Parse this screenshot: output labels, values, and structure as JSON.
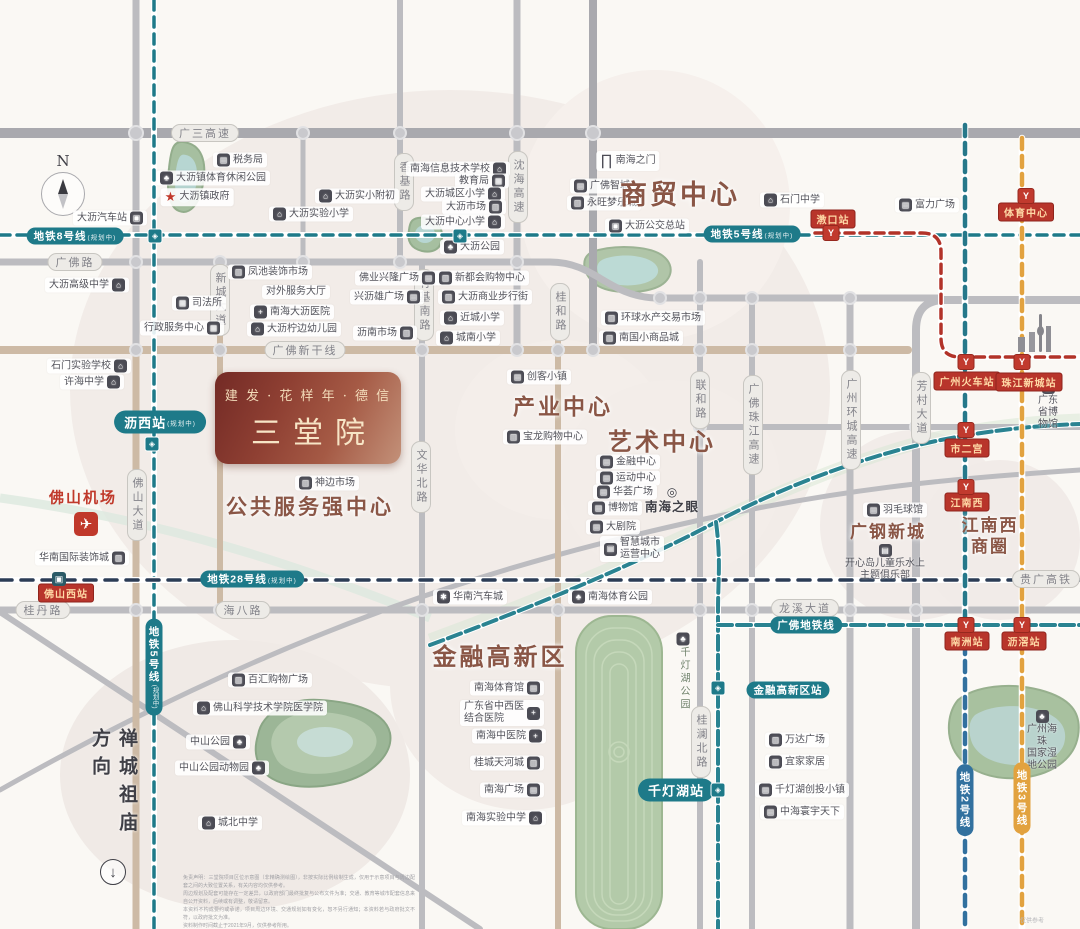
{
  "colors": {
    "metro_teal": "#1e7a89",
    "rail_navy": "#2b3c55",
    "metro_red": "#b23329",
    "metro_orange": "#e2a23f",
    "metro_blue": "#32719f",
    "brand_dark_red": "#732a25",
    "brand_bronze": "#c39179",
    "district_brown": "#8a5646",
    "road_grey": "#bcbcc0",
    "road_tan": "#cdbaa5",
    "park_green": "#a6bfa0",
    "station_badge_red": "#b8352b"
  },
  "logo": {
    "line1": "建 发 · 花 样 年 · 德 信",
    "line2": "三堂院"
  },
  "compass": {
    "n": "N"
  },
  "airport": {
    "label": "佛山机场",
    "x": 83,
    "y": 497,
    "icon": "plane-icon",
    "icon_x": 86,
    "icon_y": 524,
    "icon_glyph": "✈"
  },
  "direction_note": {
    "text": "禅城祖庙方向",
    "x": 113,
    "y": 795,
    "arrow": "↓",
    "arrow_x": 113,
    "arrow_y": 872
  },
  "watermark": {
    "text": "仅供参考",
    "x": 1032,
    "y": 920
  },
  "districts": [
    [
      "商贸中心",
      680,
      196,
      27
    ],
    [
      "产业中心",
      563,
      407,
      22
    ],
    [
      "艺术中心",
      662,
      443,
      24
    ],
    [
      "公共服务强中心",
      310,
      508,
      21
    ],
    [
      "金融高新区",
      500,
      658,
      24
    ],
    [
      "广钢新城",
      888,
      532,
      17
    ],
    [
      "江南西\n商圈",
      990,
      536,
      17
    ]
  ],
  "road_labels": [
    [
      "广三高速",
      205,
      133,
      "h"
    ],
    [
      "广佛路",
      75,
      262,
      "h"
    ],
    [
      "广佛新干线",
      305,
      350,
      "h"
    ],
    [
      "桂丹路",
      43,
      610,
      "h"
    ],
    [
      "海八路",
      243,
      610,
      "h"
    ],
    [
      "龙溪大道",
      805,
      608,
      "h"
    ],
    [
      "贵广高铁",
      1046,
      579,
      "h"
    ],
    [
      "香基路",
      404,
      182,
      "v"
    ],
    [
      "沈海高速",
      518,
      187,
      "v"
    ],
    [
      "新城大道",
      220,
      300,
      "v"
    ],
    [
      "竹基南路",
      424,
      305,
      "v"
    ],
    [
      "桂和路",
      560,
      312,
      "v"
    ],
    [
      "文华北路",
      421,
      477,
      "v"
    ],
    [
      "联和路",
      700,
      400,
      "v"
    ],
    [
      "广佛珠江高速",
      753,
      425,
      "v"
    ],
    [
      "广州环城高速",
      851,
      420,
      "v"
    ],
    [
      "芳村大道",
      921,
      408,
      "v"
    ],
    [
      "桂澜北路",
      701,
      742,
      "v"
    ],
    [
      "佛山大道",
      137,
      505,
      "v"
    ]
  ],
  "metro_pills": [
    [
      "地铁8号线",
      "(规划中)",
      75,
      236,
      "h",
      "teal",
      "s"
    ],
    [
      "地铁5号线",
      "(规划中)",
      752,
      234,
      "h",
      "teal",
      "s"
    ],
    [
      "沥西站",
      "(规划中)",
      160,
      422,
      "h",
      "teal",
      "b"
    ],
    [
      "地铁28号线",
      "(规划中)",
      252,
      579,
      "h",
      "teal",
      "s"
    ],
    [
      "地铁5号线",
      "(规划中)",
      154,
      667,
      "v",
      "teal",
      "s"
    ],
    [
      "广佛地铁线",
      "",
      806,
      625,
      "h",
      "teal",
      "s"
    ],
    [
      "金融高新区站",
      "",
      788,
      690,
      "h",
      "teal",
      "s"
    ],
    [
      "千灯湖站",
      "",
      676,
      790,
      "h",
      "teal",
      "b"
    ],
    [
      "地铁2号线",
      "",
      965,
      800,
      "v",
      "blue",
      "s"
    ],
    [
      "地铁3号线",
      "",
      1022,
      798,
      "v",
      "orange",
      "s"
    ]
  ],
  "stations": [
    [
      "漖口站",
      833,
      219,
      "y",
      831,
      233
    ],
    [
      "体育中心",
      1026,
      212,
      "y",
      1026,
      196
    ],
    [
      "广州火车站",
      967,
      381,
      "y",
      966,
      362
    ],
    [
      "珠江新城站",
      1029,
      382,
      "y",
      1022,
      362
    ],
    [
      "市二宫",
      967,
      448,
      "y",
      966,
      430
    ],
    [
      "江南西",
      967,
      502,
      "y",
      966,
      487
    ],
    [
      "南洲站",
      967,
      641,
      "y",
      966,
      625
    ],
    [
      "沥滘站",
      1024,
      641,
      "y",
      1022,
      625
    ],
    [
      "佛山西站",
      66,
      593,
      "train",
      59,
      579
    ]
  ],
  "metro_glyphs": [
    [
      155,
      236
    ],
    [
      460,
      236
    ],
    [
      152,
      444
    ],
    [
      718,
      688
    ],
    [
      718,
      790
    ]
  ],
  "pois": [
    [
      "税务局",
      240,
      160,
      "l",
      "building"
    ],
    [
      "大沥镇体育休闲公园",
      213,
      178,
      "l",
      "park"
    ],
    [
      "大沥镇政府",
      197,
      197,
      "l",
      "star"
    ],
    [
      "大沥实验小学",
      311,
      214,
      "l",
      "school"
    ],
    [
      "大沥实小附初",
      357,
      196,
      "l",
      "school"
    ],
    [
      "大沥汽车站",
      110,
      218,
      "r",
      "bus"
    ],
    [
      "南海信息技术学校",
      458,
      169,
      "r",
      "school"
    ],
    [
      "教育局",
      482,
      181,
      "r",
      "gov"
    ],
    [
      "大沥城区小学",
      463,
      194,
      "r",
      "school"
    ],
    [
      "大沥市场",
      474,
      207,
      "r",
      "market"
    ],
    [
      "大沥中心小学",
      463,
      222,
      "r",
      "school"
    ],
    [
      "大沥公园",
      472,
      247,
      "l",
      "park"
    ],
    [
      "南海之门",
      628,
      161,
      "l",
      "gate"
    ],
    [
      "广佛智城",
      602,
      186,
      "l",
      "building"
    ],
    [
      "永旺梦乐城",
      604,
      203,
      "l",
      "market"
    ],
    [
      "大沥公交总站",
      647,
      226,
      "l",
      "bus"
    ],
    [
      "石门中学",
      792,
      200,
      "l",
      "school"
    ],
    [
      "富力广场",
      927,
      205,
      "l",
      "building"
    ],
    [
      "凤池装饰市场",
      270,
      272,
      "l",
      "market"
    ],
    [
      "对外服务大厅",
      296,
      292,
      "n",
      null
    ],
    [
      "司法所",
      199,
      303,
      "l",
      "gov"
    ],
    [
      "行政服务中心",
      182,
      328,
      "r",
      "gov"
    ],
    [
      "南海大沥医院",
      292,
      312,
      "l",
      "hospital"
    ],
    [
      "大沥柠边幼儿园",
      294,
      329,
      "l",
      "school"
    ],
    [
      "大沥高级中学",
      87,
      285,
      "r",
      "school"
    ],
    [
      "石门实验学校",
      89,
      366,
      "r",
      "school"
    ],
    [
      "许海中学",
      92,
      382,
      "r",
      "school"
    ],
    [
      "佛业兴隆广场",
      397,
      278,
      "r",
      "building"
    ],
    [
      "兴沥雄广场",
      387,
      297,
      "r",
      "building"
    ],
    [
      "沥南市场",
      385,
      333,
      "r",
      "market"
    ],
    [
      "新都会购物中心",
      482,
      278,
      "l",
      "market"
    ],
    [
      "大沥商业步行街",
      485,
      297,
      "l",
      "market"
    ],
    [
      "近城小学",
      472,
      318,
      "l",
      "school"
    ],
    [
      "城南小学",
      468,
      338,
      "l",
      "school"
    ],
    [
      "环球水产交易市场",
      653,
      318,
      "l",
      "market"
    ],
    [
      "南国小商品城",
      641,
      338,
      "l",
      "market"
    ],
    [
      "创客小镇",
      539,
      377,
      "l",
      "building"
    ],
    [
      "宝龙购物中心",
      545,
      437,
      "l",
      "market"
    ],
    [
      "神边市场",
      327,
      483,
      "l",
      "market"
    ],
    [
      "金融中心",
      628,
      462,
      "l",
      "building"
    ],
    [
      "运动中心",
      628,
      478,
      "l",
      "building"
    ],
    [
      "华荟广场",
      625,
      492,
      "l",
      "building"
    ],
    [
      "博物馆",
      615,
      508,
      "l",
      "building"
    ],
    [
      "大剧院",
      613,
      527,
      "l",
      "building"
    ],
    [
      "智慧城市\n运营中心",
      632,
      549,
      "l",
      "building"
    ],
    [
      "南海之眼",
      672,
      500,
      "t",
      "eye",
      "em"
    ],
    [
      "羽毛球馆",
      895,
      510,
      "l",
      "building"
    ],
    [
      "开心岛儿童乐水上\n主题俱乐部",
      885,
      563,
      "t",
      "building"
    ],
    [
      "广东省博物馆",
      1048,
      406,
      "t",
      "building"
    ],
    [
      "华南国际装饰城",
      82,
      558,
      "r",
      "market"
    ],
    [
      "华南汽车城",
      470,
      597,
      "l",
      "gear"
    ],
    [
      "南海体育公园",
      610,
      597,
      "l",
      "park"
    ],
    [
      "千灯湖公园",
      683,
      672,
      "t",
      "park",
      "vert"
    ],
    [
      "百汇购物广场",
      270,
      680,
      "l",
      "market"
    ],
    [
      "佛山科学技术学院医学院",
      260,
      708,
      "l",
      "school"
    ],
    [
      "中山公园",
      218,
      742,
      "r",
      "park"
    ],
    [
      "中山公园动物园",
      222,
      768,
      "r",
      "park"
    ],
    [
      "城北中学",
      230,
      823,
      "l",
      "school"
    ],
    [
      "南海体育馆",
      507,
      688,
      "r",
      "building"
    ],
    [
      "广东省中西医\n结合医院",
      502,
      713,
      "r",
      "hospital"
    ],
    [
      "南海中医院",
      509,
      736,
      "r",
      "hospital"
    ],
    [
      "桂城天河城",
      507,
      763,
      "r",
      "market"
    ],
    [
      "南海广场",
      512,
      790,
      "r",
      "building"
    ],
    [
      "南海实验中学",
      504,
      818,
      "r",
      "school"
    ],
    [
      "万达广场",
      797,
      740,
      "l",
      "market"
    ],
    [
      "宜家家居",
      797,
      762,
      "l",
      "market"
    ],
    [
      "千灯湖创投小镇",
      802,
      790,
      "l",
      "building"
    ],
    [
      "中海寰宇天下",
      802,
      812,
      "l",
      "building"
    ],
    [
      "广州海珠\n国家湿地公园",
      1042,
      741,
      "t",
      "park"
    ]
  ],
  "disclaimer": {
    "x": 183,
    "y": 874,
    "w": 232,
    "lines": [
      "免责声明：三堂院项目区位示意图（非精确测绘图），非按实际比例绘制生成，仅用于示意项目与周边配套之间的大致位置关系，有关内容均仅供参考。",
      "周边规划及配套可能存在一定差异，以政府部门最终批复与公布文件为准；交通、教育等城市配套信息来自公开资料，后续或有调整，敬请留意。",
      "本资料不构成要约或承诺，项目周边环境、交通规划如有变化，恕不另行通知；本资料若与政府批文不符，以政府批文为准。",
      "资料制作时间截止于2021年9月，仅供参考所用。"
    ]
  }
}
